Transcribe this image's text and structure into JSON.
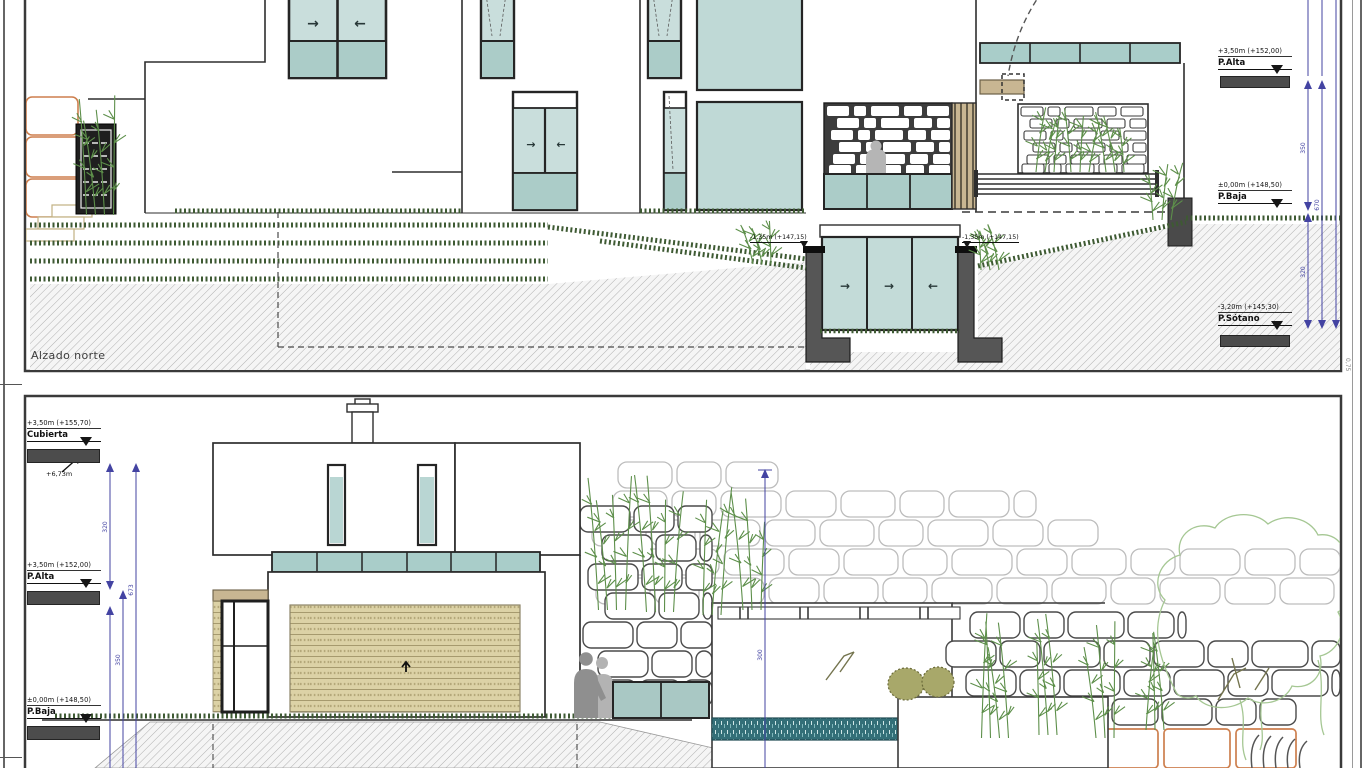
{
  "sheet": {
    "top_drawing": {
      "title": "Alzado norte",
      "levels": {
        "p_alta": {
          "elevation": "+3,50m (+152,00)",
          "name": "P.Alta"
        },
        "p_baja": {
          "elevation": "±0,00m (+148,50)",
          "name": "P.Baja"
        },
        "p_sotano": {
          "elevation": "-3,20m (+145,30)",
          "name": "P.Sótano"
        }
      },
      "spot_levels": {
        "patio_left": "-1,35m (+147,15)",
        "patio_right": "-1,35m (+147,15)"
      },
      "dimensions": {
        "floor_to_floor": "350",
        "basement": "320",
        "total": "670"
      }
    },
    "bottom_drawing": {
      "levels": {
        "cubierta": {
          "elevation": "+3,50m (+155,70)",
          "name": "Cubierta"
        },
        "p_alta": {
          "elevation": "+3,50m (+152,00)",
          "name": "P.Alta"
        },
        "p_baja": {
          "elevation": "±0,00m (+148,50)",
          "name": "P.Baja"
        }
      },
      "height_note": "+6,73m",
      "dimensions": {
        "upper": "320",
        "lower": "350",
        "total": "673",
        "garden_wall": "300"
      }
    },
    "icons": {
      "slide_right": "→",
      "slide_left": "←"
    },
    "margin_note": "0,75",
    "palette": {
      "glass": "#bfd9d6",
      "glass_dark": "#abccc8",
      "wood": "#c8b692",
      "concrete": "#565656",
      "hedge": "#3e5a33",
      "plant": "#5d8f4a",
      "dimension": "#4343a2",
      "stone_orange": "#cd7f4e"
    }
  }
}
